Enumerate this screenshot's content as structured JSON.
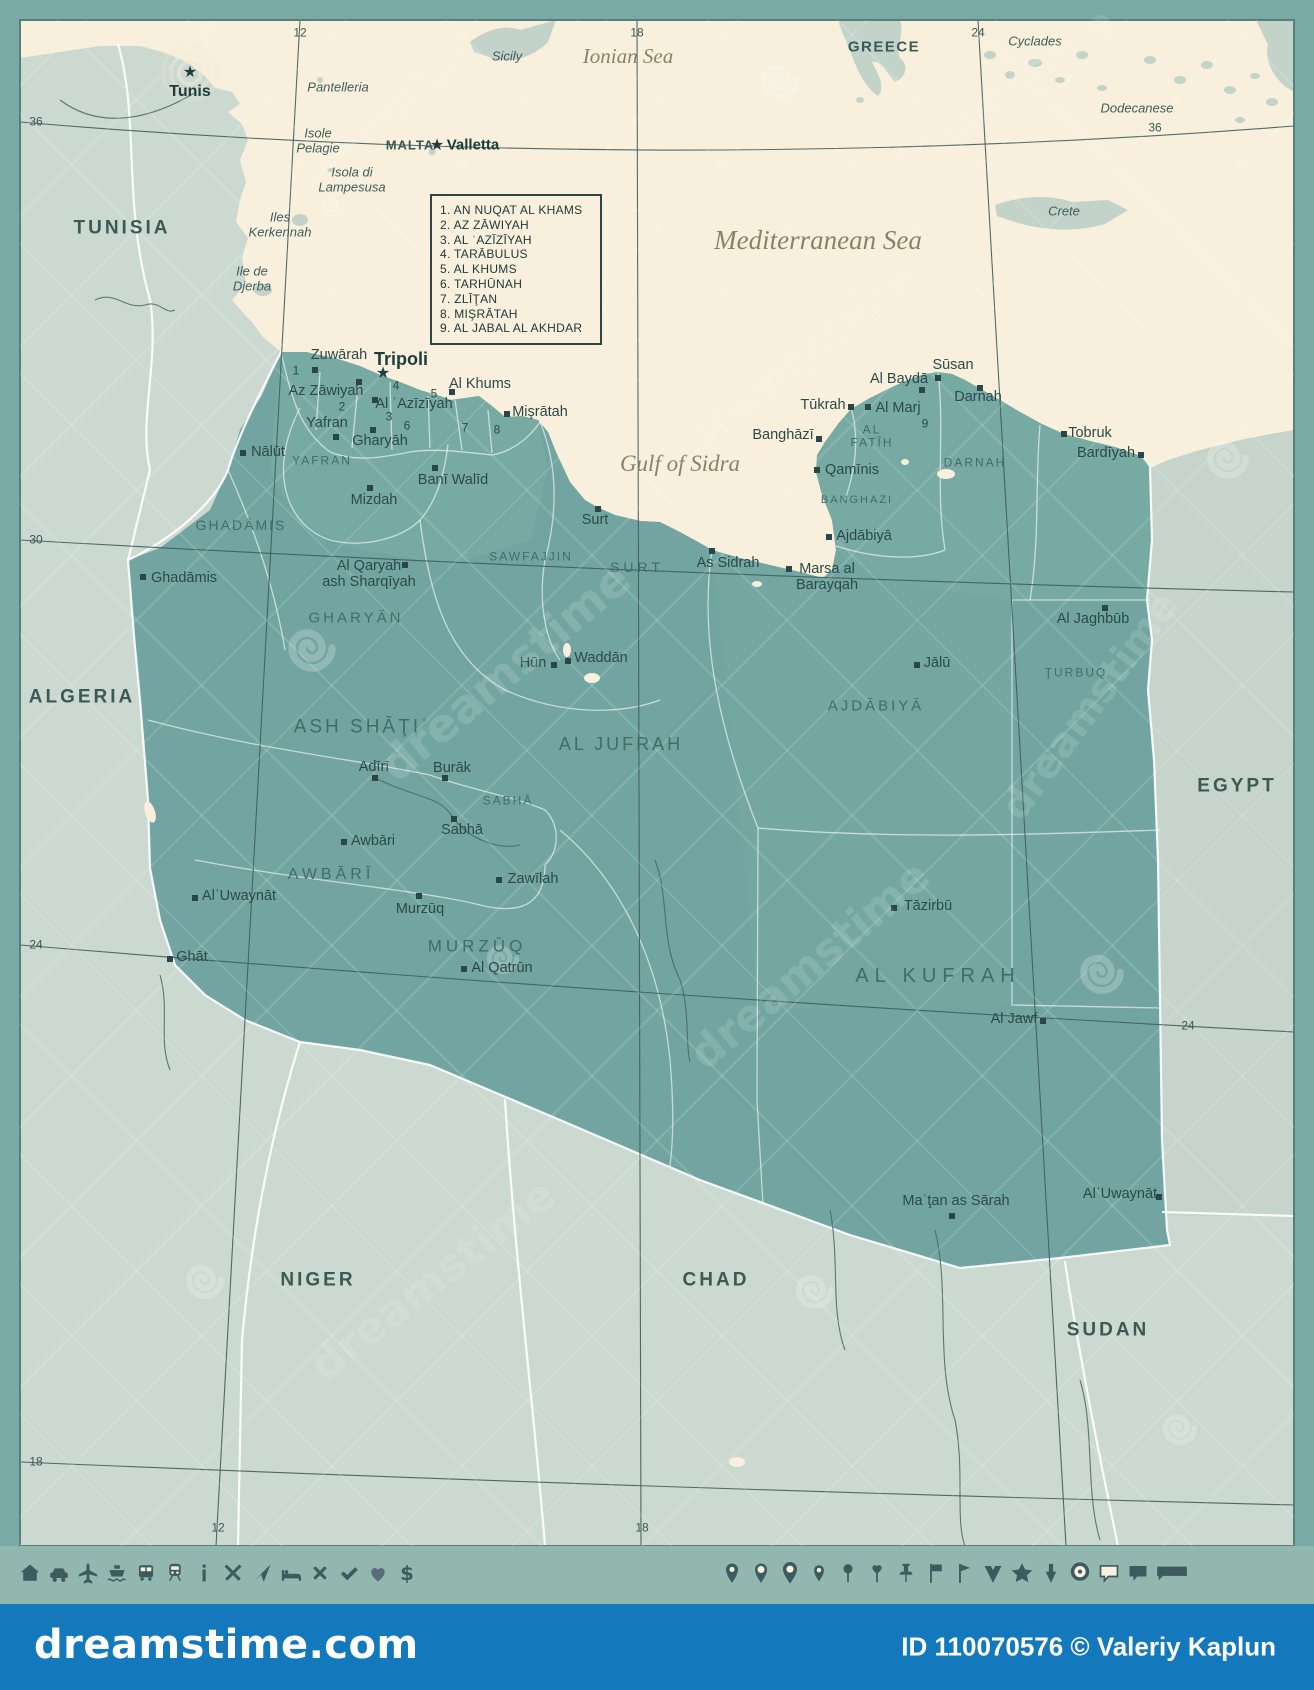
{
  "colors": {
    "frame": "#7aaaa5",
    "sea": "#f8f0dc",
    "neighbor_land": "#cbd9d0",
    "egypt": "#c6d4cb",
    "libya": "#72a5a1",
    "libya_light": "#7eafa8",
    "border_white": "#ffffff",
    "graticule": "#3e5c5e",
    "city_text": "#2c4949",
    "region_text": "#3f6966",
    "sea_text": "#8c8168",
    "icon_band": "#92b7af",
    "icon": "#3d5a5e",
    "blue_bar": "#1478bd",
    "cream": "#f8f0dc"
  },
  "icons_glyphs": {
    "capital_star": "★"
  },
  "legend": {
    "items": [
      "1. AN NUQAT AL KHAMS",
      "2. AZ ZĀWIYAH",
      "3. AL ʿAZĪZĪYAH",
      "4. TARĀBULUS",
      "5. AL KHUMS",
      "6. TARHŪNAH",
      "7. ZLĪŢAN",
      "8. MIŞRĀTAH",
      "9. AL JABAL AL AKHDAR"
    ]
  },
  "labels": {
    "graticule": [
      {
        "t": "12",
        "x": 300,
        "y": 33
      },
      {
        "t": "18",
        "x": 637,
        "y": 33
      },
      {
        "t": "24",
        "x": 978,
        "y": 33
      },
      {
        "t": "36",
        "x": 36,
        "y": 122
      },
      {
        "t": "36",
        "x": 1155,
        "y": 128
      },
      {
        "t": "30",
        "x": 36,
        "y": 540
      },
      {
        "t": "24",
        "x": 36,
        "y": 945
      },
      {
        "t": "24",
        "x": 1188,
        "y": 1026
      },
      {
        "t": "18",
        "x": 36,
        "y": 1462
      },
      {
        "t": "12",
        "x": 218,
        "y": 1528
      },
      {
        "t": "18",
        "x": 642,
        "y": 1528
      }
    ],
    "seas": [
      {
        "t": "Ionian Sea",
        "x": 628,
        "y": 57,
        "fs": 21
      },
      {
        "t": "Mediterranean Sea",
        "x": 818,
        "y": 240,
        "fs": 27
      },
      {
        "t": "Gulf of Sidra",
        "x": 680,
        "y": 464,
        "fs": 23
      }
    ],
    "islands": [
      {
        "t": "Sicily",
        "x": 507,
        "y": 57
      },
      {
        "t": "Pantelleria",
        "x": 338,
        "y": 88
      },
      {
        "t": "Isole\nPelagie",
        "x": 318,
        "y": 141
      },
      {
        "t": "Isola di\nLampesusa",
        "x": 352,
        "y": 180
      },
      {
        "t": "Iles\nKerkennah",
        "x": 280,
        "y": 225
      },
      {
        "t": "Ile de\nDjerba",
        "x": 252,
        "y": 279
      },
      {
        "t": "Cyclades",
        "x": 1035,
        "y": 42
      },
      {
        "t": "Dodecanese",
        "x": 1137,
        "y": 109
      },
      {
        "t": "Crete",
        "x": 1064,
        "y": 212
      }
    ],
    "countries": [
      {
        "t": "GREECE",
        "x": 884,
        "y": 48,
        "fs": 15,
        "ls": 1.5
      },
      {
        "t": "MALTA",
        "x": 410,
        "y": 146,
        "fs": 13,
        "ls": 1
      },
      {
        "t": "TUNISIA",
        "x": 122,
        "y": 228
      },
      {
        "t": "ALGERIA",
        "x": 82,
        "y": 697
      },
      {
        "t": "NIGER",
        "x": 318,
        "y": 1280
      },
      {
        "t": "CHAD",
        "x": 716,
        "y": 1280
      },
      {
        "t": "SUDAN",
        "x": 1108,
        "y": 1330
      },
      {
        "t": "EGYPT",
        "x": 1237,
        "y": 786
      }
    ],
    "regions": [
      {
        "t": "GHADĀMIS",
        "x": 241,
        "y": 526,
        "fs": 14
      },
      {
        "t": "YAFRAN",
        "x": 322,
        "y": 461,
        "fs": 12
      },
      {
        "t": "GHARYĀN",
        "x": 356,
        "y": 619,
        "fs": 15,
        "ls": 3
      },
      {
        "t": "SAWFAJJIN",
        "x": 531,
        "y": 557,
        "fs": 12
      },
      {
        "t": "SURT",
        "x": 637,
        "y": 568,
        "fs": 14,
        "ls": 4
      },
      {
        "t": "ASH SHĀŢIʿ",
        "x": 362,
        "y": 727,
        "fs": 19,
        "ls": 3
      },
      {
        "t": "AL JUFRAH",
        "x": 621,
        "y": 744,
        "fs": 18,
        "ls": 3
      },
      {
        "t": "SABHĀ",
        "x": 508,
        "y": 801,
        "fs": 12
      },
      {
        "t": "AWBĀRĪ",
        "x": 331,
        "y": 875,
        "fs": 16,
        "ls": 4
      },
      {
        "t": "MURZŪQ",
        "x": 477,
        "y": 946,
        "fs": 17,
        "ls": 4
      },
      {
        "t": "AJDĀBIYĀ",
        "x": 876,
        "y": 707,
        "fs": 15,
        "ls": 3
      },
      {
        "t": "AL\nFATĪH",
        "x": 872,
        "y": 437,
        "fs": 12
      },
      {
        "t": "BANGHAZI",
        "x": 857,
        "y": 500,
        "fs": 11
      },
      {
        "t": "DARNAH",
        "x": 975,
        "y": 463,
        "fs": 12
      },
      {
        "t": "ŢURBUQ",
        "x": 1076,
        "y": 673,
        "fs": 12
      },
      {
        "t": "AL KUFRAH",
        "x": 938,
        "y": 976,
        "fs": 20,
        "ls": 6
      }
    ],
    "cities": [
      {
        "t": "Zuwārah",
        "x": 339,
        "y": 355,
        "mx": 315,
        "my": 370
      },
      {
        "t": "Az Zāwiyah",
        "x": 326,
        "y": 391,
        "mx": 359,
        "my": 382
      },
      {
        "t": "Al ʿAzīzīyah",
        "x": 414,
        "y": 404,
        "mx": 375,
        "my": 400
      },
      {
        "t": "Al Khums",
        "x": 480,
        "y": 384,
        "mx": 452,
        "my": 392
      },
      {
        "t": "Mişrātah",
        "x": 540,
        "y": 412,
        "mx": 507,
        "my": 414
      },
      {
        "t": "Yafran",
        "x": 327,
        "y": 423,
        "mx": 336,
        "my": 437
      },
      {
        "t": "Gharyāh",
        "x": 380,
        "y": 441,
        "mx": 373,
        "my": 430
      },
      {
        "t": "Nālūt",
        "x": 268,
        "y": 452,
        "mx": 243,
        "my": 453
      },
      {
        "t": "Banī Walīd",
        "x": 453,
        "y": 480,
        "mx": 435,
        "my": 468
      },
      {
        "t": "Mizdah",
        "x": 374,
        "y": 500,
        "mx": 370,
        "my": 488
      },
      {
        "t": "Ghadāmis",
        "x": 184,
        "y": 578,
        "mx": 143,
        "my": 577
      },
      {
        "t": "Al Qaryah\nash Sharqīyah",
        "x": 369,
        "y": 574,
        "mx": 405,
        "my": 565
      },
      {
        "t": "Surt",
        "x": 595,
        "y": 520,
        "mx": 598,
        "my": 509
      },
      {
        "t": "As Sidrah",
        "x": 728,
        "y": 563,
        "mx": 712,
        "my": 551
      },
      {
        "t": "Marsa al\nBarayqah",
        "x": 827,
        "y": 577,
        "mx": 789,
        "my": 569
      },
      {
        "t": "Hūn",
        "x": 533,
        "y": 663,
        "mx": 554,
        "my": 665
      },
      {
        "t": "Waddān",
        "x": 601,
        "y": 658,
        "mx": 568,
        "my": 661
      },
      {
        "t": "Adīrī",
        "x": 374,
        "y": 767,
        "mx": 375,
        "my": 778
      },
      {
        "t": "Burāk",
        "x": 452,
        "y": 768,
        "mx": 445,
        "my": 778
      },
      {
        "t": "Sabhā",
        "x": 462,
        "y": 830,
        "mx": 454,
        "my": 819
      },
      {
        "t": "Awbāri",
        "x": 373,
        "y": 841,
        "mx": 344,
        "my": 842
      },
      {
        "t": "AlʿUwaynāt",
        "x": 239,
        "y": 896,
        "mx": 195,
        "my": 898
      },
      {
        "t": "Ghāt",
        "x": 192,
        "y": 957,
        "mx": 170,
        "my": 959
      },
      {
        "t": "Zawīlah",
        "x": 533,
        "y": 879,
        "mx": 499,
        "my": 880
      },
      {
        "t": "Murzūq",
        "x": 420,
        "y": 909,
        "mx": 419,
        "my": 896
      },
      {
        "t": "Al Qatrūn",
        "x": 502,
        "y": 968,
        "mx": 464,
        "my": 969
      },
      {
        "t": "Sūsan",
        "x": 953,
        "y": 365,
        "mx": 938,
        "my": 378
      },
      {
        "t": "Al Baydā",
        "x": 899,
        "y": 379,
        "mx": 922,
        "my": 390
      },
      {
        "t": "Darnah",
        "x": 978,
        "y": 397,
        "mx": 980,
        "my": 388
      },
      {
        "t": "Tūkrah",
        "x": 823,
        "y": 405,
        "mx": 851,
        "my": 407
      },
      {
        "t": "Al Marj",
        "x": 898,
        "y": 408,
        "mx": 868,
        "my": 407
      },
      {
        "t": "Banghāzī",
        "x": 783,
        "y": 435,
        "mx": 819,
        "my": 439
      },
      {
        "t": "Qamīnis",
        "x": 852,
        "y": 470,
        "mx": 817,
        "my": 470
      },
      {
        "t": "Ajdābiyā",
        "x": 864,
        "y": 536,
        "mx": 829,
        "my": 537
      },
      {
        "t": "Tobruk",
        "x": 1090,
        "y": 433,
        "mx": 1064,
        "my": 434
      },
      {
        "t": "Bardīyah",
        "x": 1106,
        "y": 453,
        "mx": 1141,
        "my": 455
      },
      {
        "t": "Al Jaghbūb",
        "x": 1093,
        "y": 619,
        "mx": 1105,
        "my": 608
      },
      {
        "t": "Jālū",
        "x": 937,
        "y": 663,
        "mx": 917,
        "my": 665
      },
      {
        "t": "Tāzirbū",
        "x": 928,
        "y": 906,
        "mx": 894,
        "my": 908
      },
      {
        "t": "Al Jawf",
        "x": 1014,
        "y": 1019,
        "mx": 1043,
        "my": 1021
      },
      {
        "t": "Maʿţan as Sārah",
        "x": 956,
        "y": 1201,
        "mx": 952,
        "my": 1216
      },
      {
        "t": "AlʿUwaynāt",
        "x": 1120,
        "y": 1194,
        "mx": 1159,
        "my": 1197
      }
    ],
    "numbers": [
      {
        "t": "1",
        "x": 296,
        "y": 371
      },
      {
        "t": "2",
        "x": 342,
        "y": 407
      },
      {
        "t": "3",
        "x": 389,
        "y": 417
      },
      {
        "t": "4",
        "x": 396,
        "y": 386
      },
      {
        "t": "5",
        "x": 434,
        "y": 394
      },
      {
        "t": "6",
        "x": 407,
        "y": 426
      },
      {
        "t": "7",
        "x": 465,
        "y": 428
      },
      {
        "t": "8",
        "x": 497,
        "y": 430
      },
      {
        "t": "9",
        "x": 925,
        "y": 424
      }
    ]
  },
  "capitals": [
    {
      "t": "Tripoli",
      "x": 401,
      "y": 359,
      "fs": 18,
      "sx": 383,
      "sy": 374
    },
    {
      "t": "Tunis",
      "x": 190,
      "y": 92,
      "fs": 16,
      "sx": 190,
      "sy": 73
    },
    {
      "t": "Valletta",
      "x": 473,
      "y": 146,
      "fs": 15,
      "sx": 437,
      "sy": 146
    }
  ],
  "footer": {
    "icons_left": [
      "home",
      "car",
      "plane",
      "ship",
      "bus",
      "train",
      "info",
      "restaurant",
      "navigation",
      "hotel",
      "close",
      "check",
      "heart",
      "dollar"
    ],
    "icons_right": [
      "pin-round",
      "pin-circle",
      "pin-large",
      "pin-small",
      "pin-ball",
      "pin-heart",
      "pushpin",
      "flag",
      "flag-pennant",
      "chevron-pin",
      "star",
      "arrow-pin",
      "target",
      "speech-light",
      "speech-dark",
      "speech-wide"
    ]
  },
  "branding": {
    "watermark": "dreamstime",
    "logo": "dreamstime.com",
    "credit": "ID 110070576 © Valeriy Kaplun"
  },
  "watermark_instances": [
    {
      "x": 1000,
      "y": 95,
      "rot": -35,
      "fs": 40,
      "op": 0.11
    },
    {
      "x": 800,
      "y": 360,
      "rot": -38,
      "fs": 42,
      "op": 0.12
    },
    {
      "x": 380,
      "y": 120,
      "rot": -35,
      "fs": 36,
      "op": 0.09
    },
    {
      "x": 505,
      "y": 672,
      "rot": -40,
      "fs": 46,
      "op": 0.14
    },
    {
      "x": 1090,
      "y": 706,
      "rot": -54,
      "fs": 40,
      "op": 0.13
    },
    {
      "x": 810,
      "y": 965,
      "rot": -40,
      "fs": 44,
      "op": 0.13
    },
    {
      "x": 433,
      "y": 1280,
      "rot": -38,
      "fs": 44,
      "op": 0.12
    }
  ]
}
